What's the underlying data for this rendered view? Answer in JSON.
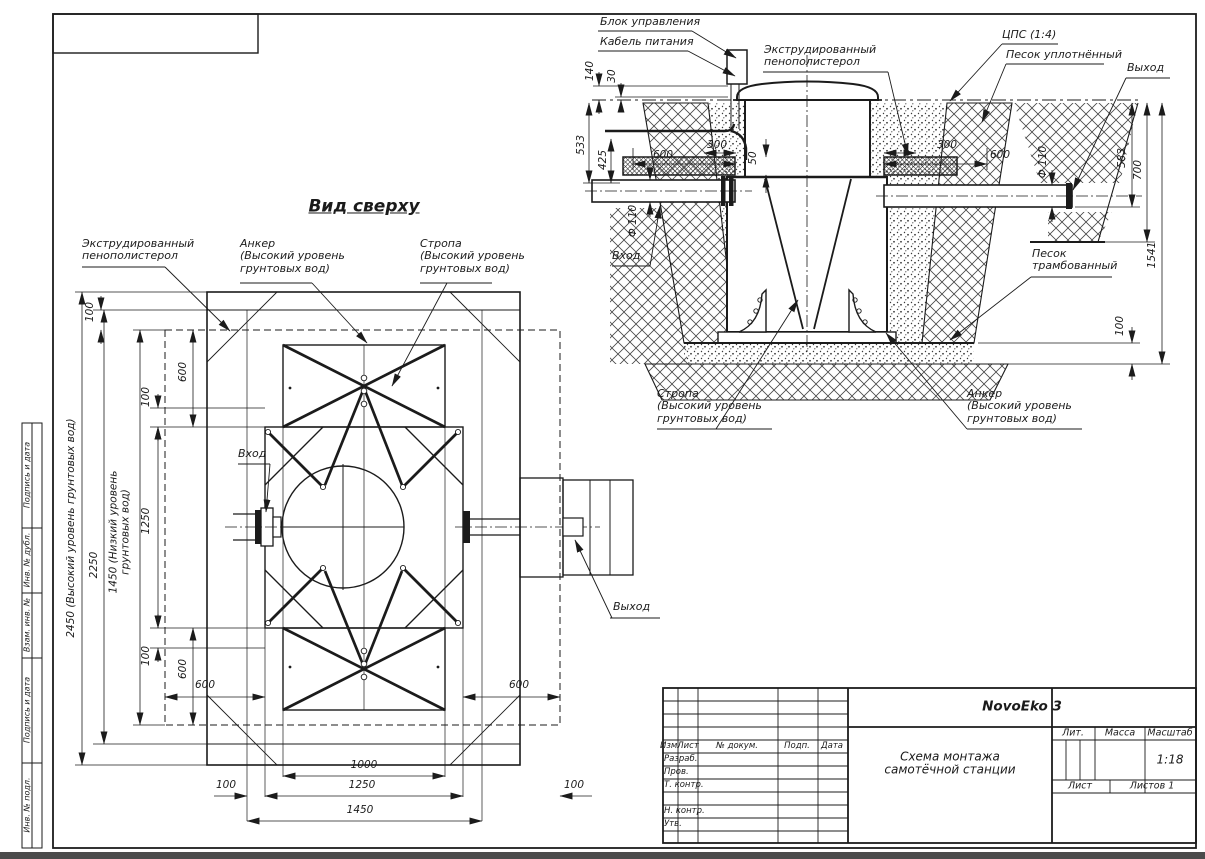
{
  "colors": {
    "line": "#1b1b1b",
    "bottom_bar": "#4b4b4b",
    "paper": "#ffffff"
  },
  "frame": {
    "fields": [
      "Подпись и дата",
      "Инв. № дубл.",
      "Взам. инв. №",
      "Подпись и дата",
      "Инв. № подл."
    ]
  },
  "section": {
    "labels": {
      "control_unit": "Блок управления",
      "power_cable": "Кабель питания",
      "foam": "Экструдированный\nпенополистерол",
      "cps": "ЦПС (1:4)",
      "sand_compacted": "Песок уплотнённый",
      "outlet": "Выход",
      "inlet": "Вход",
      "sand_rammed": "Песок\nтрамбованный",
      "sling": "Стропа\n(Высокий уровень\nгрунтовых вод)",
      "anchor": "Анкер\n(Высокий уровень\nгрунтовых вод)"
    },
    "dims": {
      "d140": "140",
      "d30": "30",
      "d533": "533",
      "d425": "425",
      "d600": "600",
      "d300": "300",
      "d50": "50",
      "dia110": "Ф 110",
      "d583": "583",
      "d700": "700",
      "d1541": "1541",
      "d100": "100"
    }
  },
  "plan": {
    "title": "Вид сверху",
    "labels": {
      "foam": "Экструдированный\nпенополистерол",
      "anchor": "Анкер\n(Высокий уровень\nгрунтовых вод)",
      "sling": "Стропа\n(Высокий уровень\nгрунтовых вод)",
      "inlet": "Вход",
      "outlet": "Выход"
    },
    "dims": {
      "d2450": "2450 (Высокий уровень грунтовых вод)",
      "d2250": "2250",
      "d1450gw": "1450 (Низкий уровень\nгрунтовых вод)",
      "d1250": "1250",
      "d1000": "1000",
      "d1450": "1450",
      "d600": "600",
      "d100": "100"
    }
  },
  "title_block": {
    "product": "NovoEko 3",
    "doc_title": "Схема монтажа\nсамотёчной станции",
    "scale_value": "1:18",
    "cols": {
      "izm": "Изм.",
      "list": "Лист",
      "doc": "№ докум.",
      "sign": "Подп.",
      "date": "Дата"
    },
    "rows": {
      "developed": "Разраб.",
      "checked": "Пров.",
      "tcontrol": "Т. контр.",
      "ncontrol": "Н. контр.",
      "approved": "Утв."
    },
    "props": {
      "lit": "Лит.",
      "mass": "Масса",
      "scale": "Масштаб",
      "sheet": "Лист",
      "sheets": "Листов 1"
    }
  }
}
